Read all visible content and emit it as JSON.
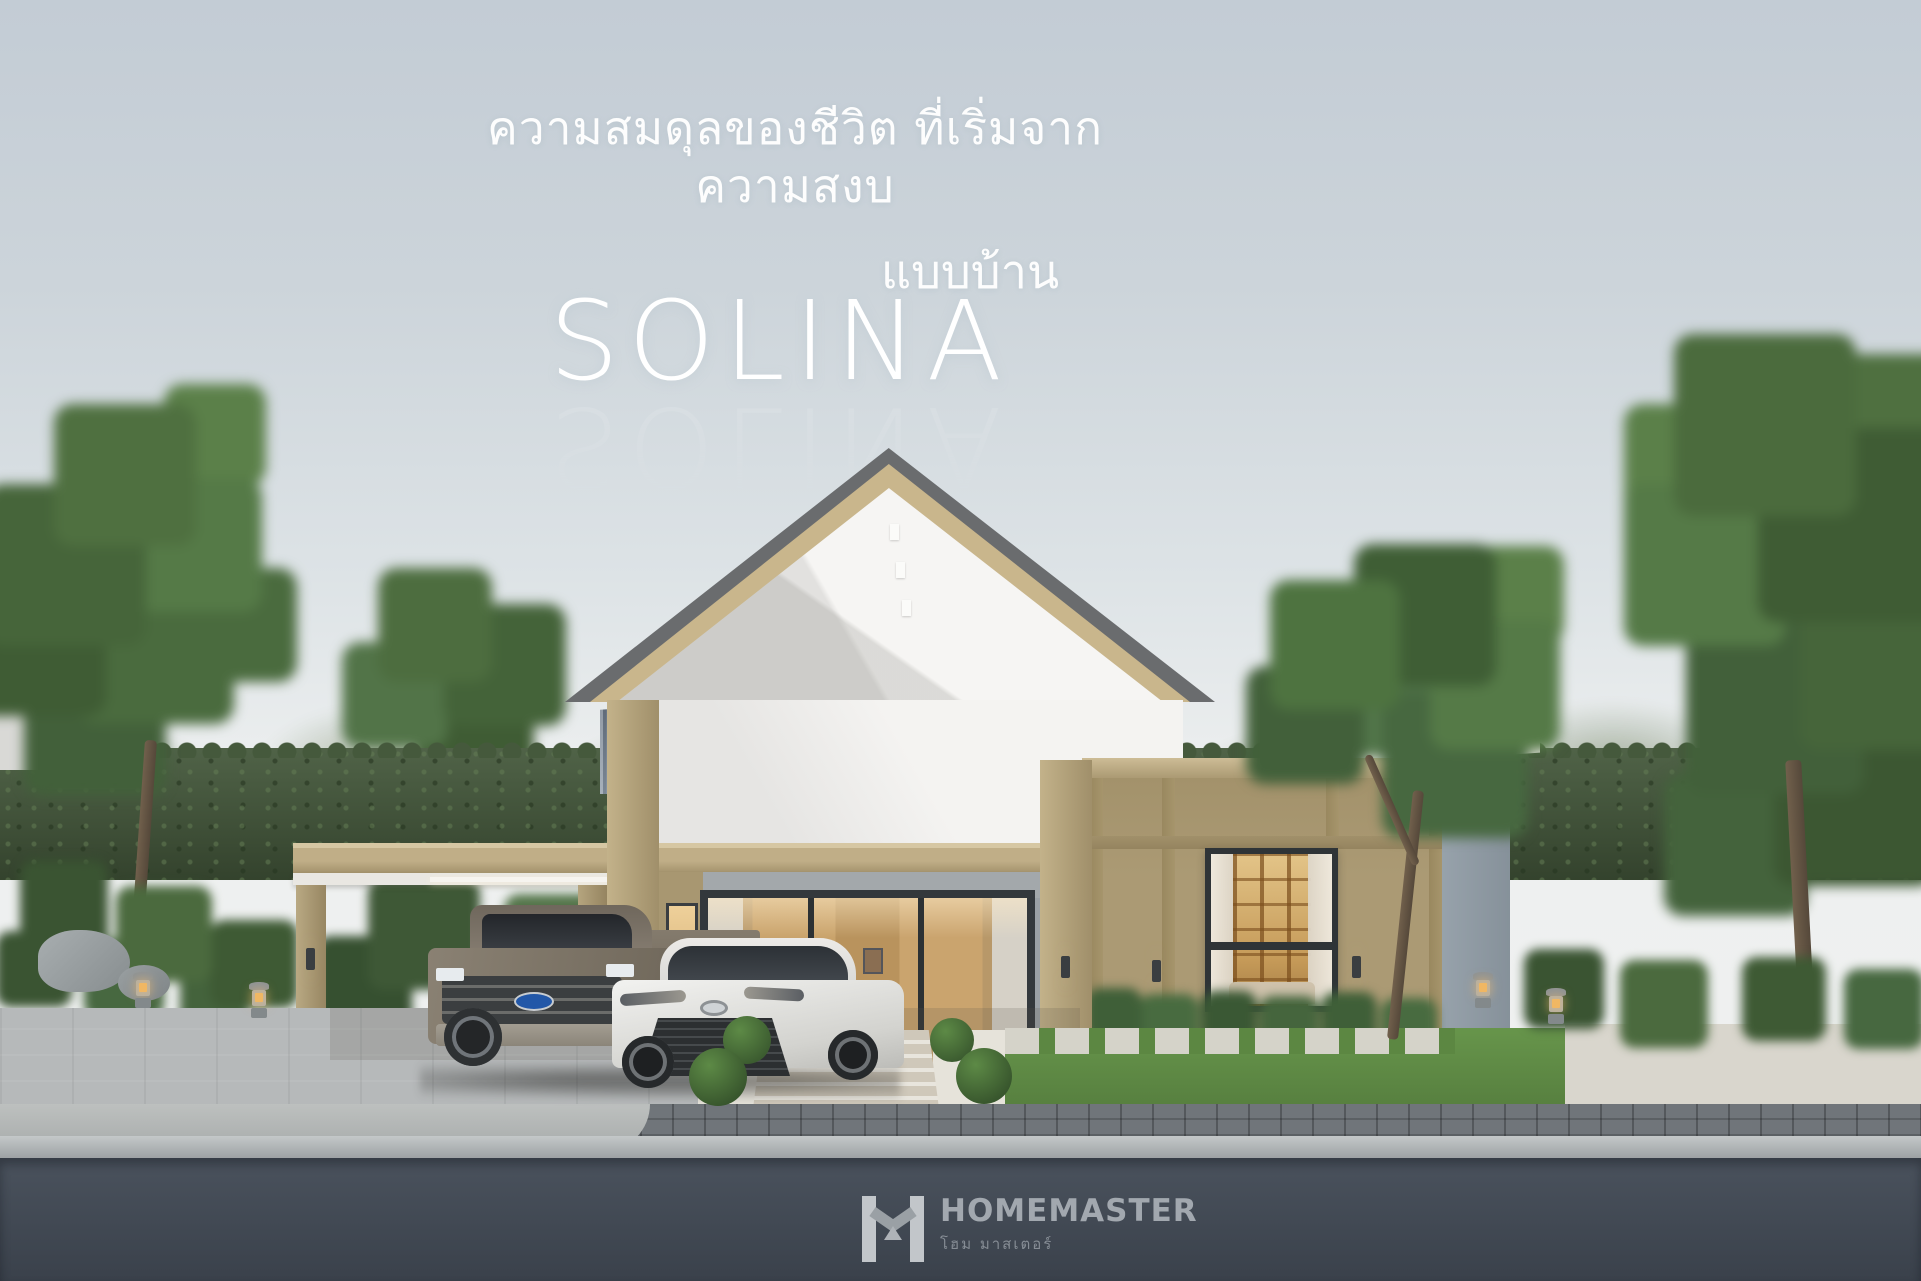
{
  "poster": {
    "tagline": "ความสมดุลของชีวิต ที่เริ่มจากความสงบ",
    "series_label": "แบบบ้าน",
    "model_name": "SOLINA"
  },
  "brand": {
    "name": "HOMEMASTER",
    "name_thai": "โฮม มาสเตอร์",
    "icon": "homemaster-h-roof-icon"
  },
  "scene": {
    "elements": [
      "sky",
      "distant-tree-line",
      "hedge",
      "left-tree",
      "right-tree",
      "garden-tree",
      "single-story-house",
      "gable-roof",
      "standing-seam-metal-roof",
      "carport",
      "pickup-truck",
      "white-sedan",
      "glass-entrance-door",
      "bedroom-window",
      "wall-sconces",
      "topiary-bushes",
      "stone-lanterns",
      "lawn",
      "paver-walkway",
      "driveway",
      "sidewalk",
      "curb",
      "asphalt-road"
    ],
    "colors": {
      "sky_top": "#c3ccd5",
      "sky_horizon": "#eef0f0",
      "gable_white": "#f5f4f2",
      "trim_tan": "#b3a17c",
      "wall_tan": "#ab9a74",
      "roof_edge_dark": "#6a6c6e",
      "metal_roof_blue_grey": "#67737f",
      "hedge_green": "#45593c",
      "lawn_green": "#5f8c44",
      "warm_window_light": "#d9b077",
      "window_frame_dark": "#2f3437",
      "driveway_grey": "#b6b9ba",
      "sidewalk_paver_grey": "#70757a",
      "curb_grey": "#b4b8ba",
      "road_asphalt": "#414a55",
      "headline_white": "#ffffff",
      "brand_grey": "#9aa0a7"
    }
  }
}
